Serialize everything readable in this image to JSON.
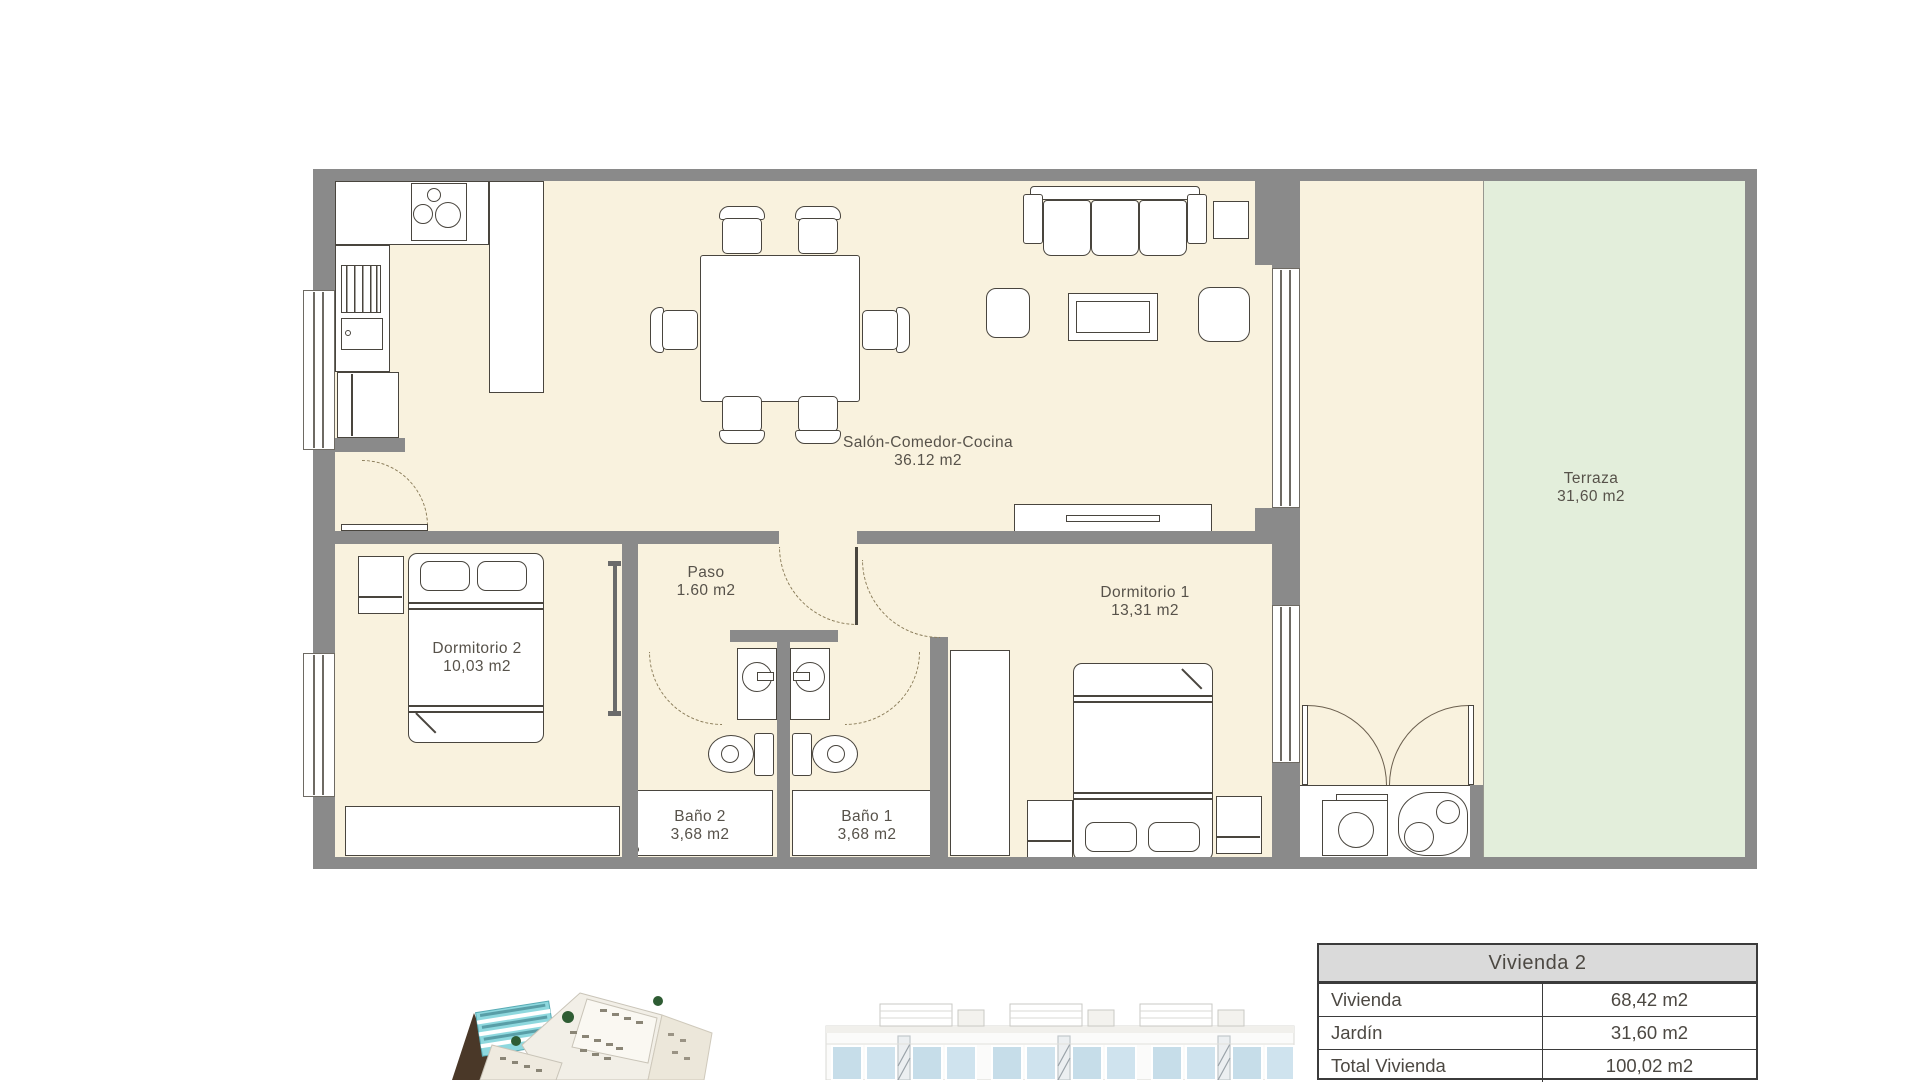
{
  "plan": {
    "rooms": {
      "salon": {
        "name": "Salón-Comedor-Cocina",
        "area": "36.12 m2"
      },
      "paso": {
        "name": "Paso",
        "area": "1.60 m2"
      },
      "dormitorio2": {
        "name": "Dormitorio 2",
        "area": "10,03 m2"
      },
      "dormitorio1": {
        "name": "Dormitorio 1",
        "area": "13,31 m2"
      },
      "bano2": {
        "name": "Baño 2",
        "area": "3,68 m2"
      },
      "bano1": {
        "name": "Baño 1",
        "area": "3,68 m2"
      },
      "terraza": {
        "name": "Terraza",
        "area": "31,60 m2"
      }
    },
    "colors": {
      "floor": "#f9f2de",
      "garden": "#e3eedb",
      "wall": "#8a8a8a",
      "stroke": "#49453e"
    }
  },
  "summary_table": {
    "title": "Vivienda 2",
    "rows": [
      {
        "label": "Vivienda",
        "value": "68,42 m2"
      },
      {
        "label": "Jardín",
        "value": "31,60 m2"
      },
      {
        "label": "Total Vivienda",
        "value": "100,02 m2"
      }
    ]
  },
  "images": {
    "aerial_render": "aerial-complex-render",
    "elevation_render": "building-elevation-render"
  }
}
